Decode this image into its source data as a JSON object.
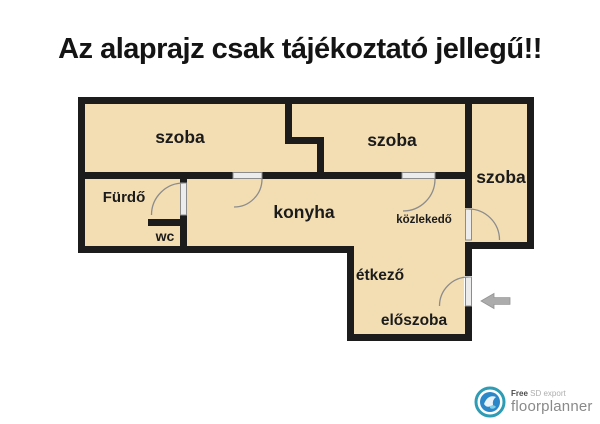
{
  "title": "Az alaprajz csak tájékoztató jellegű!!",
  "colors": {
    "room_fill": "#F3DEB4",
    "wall": "#1C1C1C",
    "door_leaf": "#ECECEC",
    "door_arc": "#8C8C8C",
    "arrow": "#ACACAC",
    "logo_teal": "#2D9CB4",
    "logo_blue": "#2B87C8"
  },
  "plan": {
    "rooms": [
      {
        "id": "szoba-1",
        "label": "szoba"
      },
      {
        "id": "szoba-2",
        "label": "szoba"
      },
      {
        "id": "szoba-3",
        "label": "szoba"
      },
      {
        "id": "furdo",
        "label": "Fürdő"
      },
      {
        "id": "wc",
        "label": "wc"
      },
      {
        "id": "konyha",
        "label": "konyha"
      },
      {
        "id": "kozlekedo",
        "label": "közlekedő"
      },
      {
        "id": "etkezo",
        "label": "étkező"
      },
      {
        "id": "eloszoba",
        "label": "előszoba"
      }
    ],
    "entrance_arrow": "left"
  },
  "footer": {
    "free": "Free",
    "sd_export": "SD export",
    "brand": "floorplanner"
  }
}
